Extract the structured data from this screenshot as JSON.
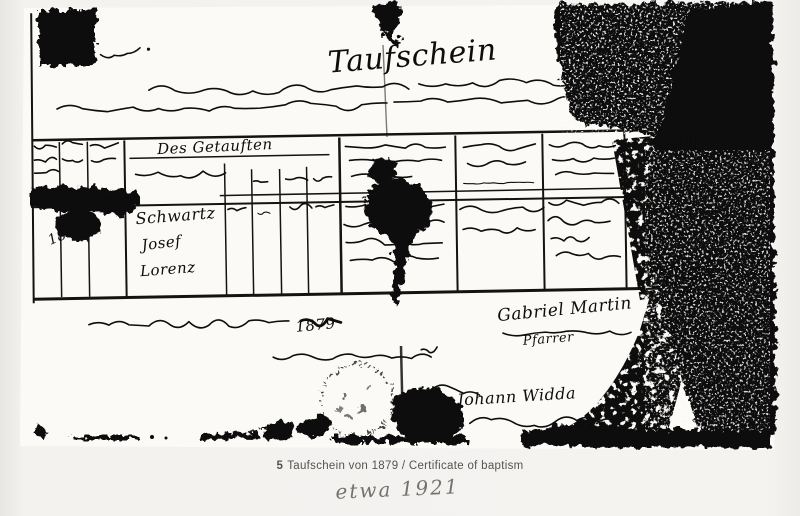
{
  "page": {
    "background_color": "#f4f2ef",
    "caption": {
      "number": "5",
      "text": "Taufschein von 1879 / Certificate of baptism"
    },
    "handwritten_annotation": "etwa 1921"
  },
  "document": {
    "kind": "scanned handwritten certificate of baptism with ruled table, ink blots, fold lines and round stamp",
    "paper_color": "#fbfaf7",
    "ink_color": "#0e0d0b",
    "title_script": "Taufschein",
    "table": {
      "header_span_label": "Des Getauften",
      "entries": {
        "names": [
          "Schwartz",
          "Josef",
          "Lorenz"
        ],
        "year_left_column": "1811"
      }
    },
    "date_line_year": "1879",
    "signatures": {
      "officiant": "Gabriel Martin",
      "officiant_title": "Pfarrer",
      "second": "Johann Widda"
    }
  }
}
